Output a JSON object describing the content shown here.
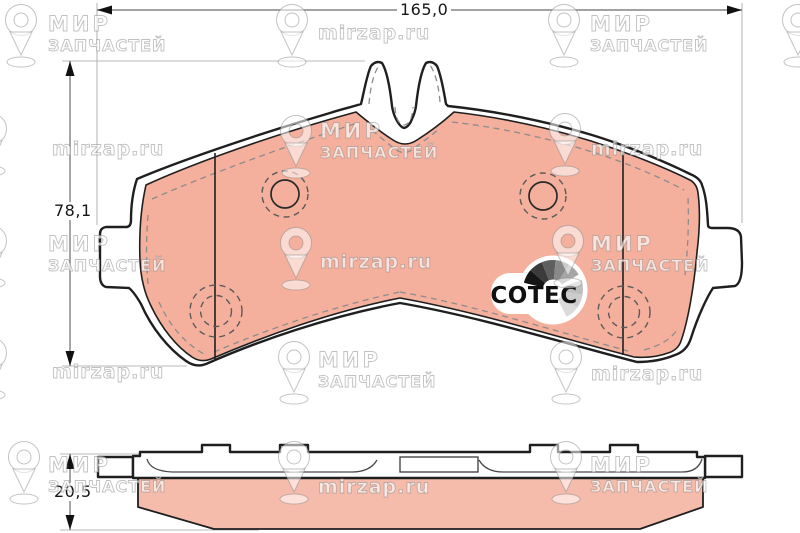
{
  "dimensions": {
    "width": {
      "label": "165,0"
    },
    "height": {
      "label": "78,1"
    },
    "thickness": {
      "label": "20,5"
    }
  },
  "logo": {
    "text": "COTEC",
    "fan": {
      "cx": 553,
      "cy": 290,
      "r": 30,
      "hub_r": 10.5,
      "segments": [
        {
          "a0": 166,
          "a1": 139,
          "color": "#161616"
        },
        {
          "a0": 139,
          "a1": 112,
          "color": "#3b3b3b"
        },
        {
          "a0": 112,
          "a1": 85,
          "color": "#5f5f5f"
        },
        {
          "a0": 85,
          "a1": 58,
          "color": "#898989"
        },
        {
          "a0": 58,
          "a1": 31,
          "color": "#a6a6a6"
        },
        {
          "a0": 19,
          "a1": -9,
          "color": "#bfbfbf"
        },
        {
          "a0": -9,
          "a1": -36,
          "color": "#cccccc"
        },
        {
          "a0": -36,
          "a1": -63,
          "color": "#dbdbdb"
        }
      ]
    }
  },
  "watermark": {
    "name_line1": "МИР",
    "name_line2": "ЗАПЧАСТЕЙ",
    "site": "mirzap.ru",
    "items": [
      {
        "pin_x": 2,
        "pin_y": 3,
        "variant": "name",
        "tx": 48,
        "ty": 14
      },
      {
        "pin_x": 273,
        "pin_y": 3,
        "variant": "site",
        "tx": 318,
        "ty": 23
      },
      {
        "pin_x": 545,
        "pin_y": 3,
        "variant": "name",
        "tx": 590,
        "ty": 14
      },
      {
        "pin_x": 779,
        "pin_y": 3,
        "variant": "",
        "tx": 0,
        "ty": 0
      },
      {
        "pin_x": -28,
        "pin_y": 112,
        "variant": "site",
        "tx": 52,
        "ty": 139
      },
      {
        "pin_x": 277,
        "pin_y": 114,
        "variant": "name",
        "tx": 320,
        "ty": 121
      },
      {
        "pin_x": 546,
        "pin_y": 112,
        "variant": "site",
        "tx": 591,
        "ty": 139
      },
      {
        "pin_x": -28,
        "pin_y": 224,
        "variant": "name",
        "tx": 48,
        "ty": 234
      },
      {
        "pin_x": 277,
        "pin_y": 226,
        "variant": "site",
        "tx": 320,
        "ty": 252
      },
      {
        "pin_x": 549,
        "pin_y": 224,
        "variant": "name",
        "tx": 591,
        "ty": 234
      },
      {
        "pin_x": -28,
        "pin_y": 336,
        "variant": "site",
        "tx": 52,
        "ty": 362
      },
      {
        "pin_x": 275,
        "pin_y": 340,
        "variant": "name",
        "tx": 318,
        "ty": 350
      },
      {
        "pin_x": 547,
        "pin_y": 340,
        "variant": "site",
        "tx": 591,
        "ty": 364
      },
      {
        "pin_x": 5,
        "pin_y": 440,
        "variant": "name",
        "tx": 48,
        "ty": 455
      },
      {
        "pin_x": 275,
        "pin_y": 440,
        "variant": "site",
        "tx": 318,
        "ty": 477
      },
      {
        "pin_x": 547,
        "pin_y": 440,
        "variant": "name",
        "tx": 590,
        "ty": 455
      }
    ]
  },
  "colors": {
    "friction": "#f4b09d",
    "friction_side": "#f5bcab",
    "outline": "#1f1f1f",
    "dash_detail": "#8c8c8c",
    "dimension_line": "#6b6b6b",
    "extension_line": "#b9b9b9"
  }
}
